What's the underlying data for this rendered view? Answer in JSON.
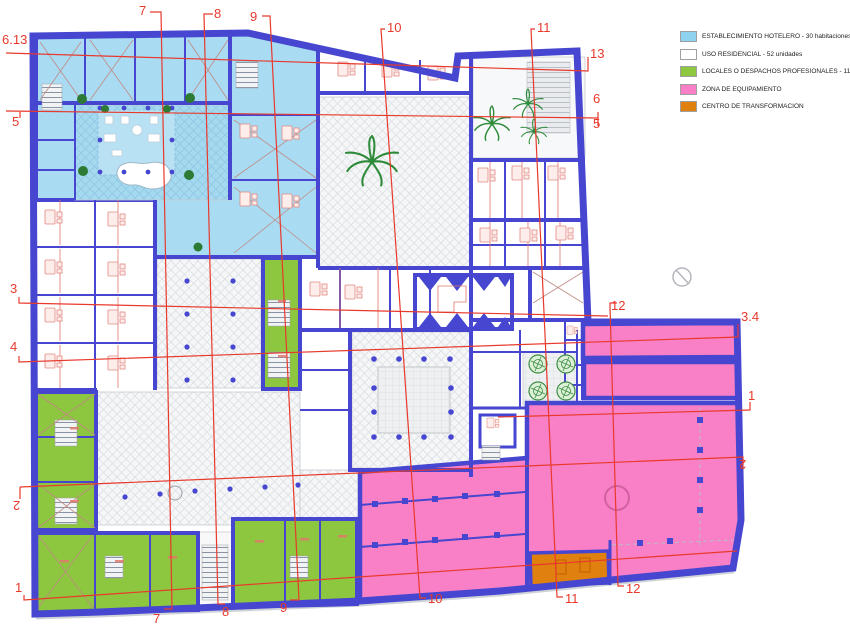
{
  "legend": {
    "items": [
      {
        "id": "hotel",
        "label": "ESTABLECIMIENTO HOTELERO - 30 habitaciones",
        "color": "#8fd2f0"
      },
      {
        "id": "residencial",
        "label": "USO RESIDENCIAL - 52 unidades",
        "color": "#ffffff"
      },
      {
        "id": "locales",
        "label": "LOCALES O DESPACHOS PROFESIONALES - 11 unidades",
        "color": "#8dc63f"
      },
      {
        "id": "equipamiento",
        "label": "ZONA DE EQUIPAMIENTO",
        "color": "#f980c6"
      },
      {
        "id": "transformacion",
        "label": "CENTRO DE TRANSFORMACION",
        "color": "#e0800f"
      }
    ]
  },
  "grid_labels": {
    "top": [
      "7",
      "8",
      "9",
      "10",
      "11"
    ],
    "bottom": [
      "7",
      "8",
      "9",
      "10",
      "11",
      "12"
    ],
    "left": [
      "6.13",
      "5",
      "3",
      "4",
      "2",
      "1"
    ],
    "right": [
      "13",
      "6",
      "5",
      "12",
      "3.4",
      "1",
      "2",
      "12"
    ]
  },
  "colors": {
    "wall_blue": "#4646d0",
    "hotel_blue": "#a9dcf3",
    "legend_hotel_blue": "#8fd2f0",
    "locales_green": "#8dc63f",
    "equipamiento_pink": "#f980c6",
    "transformacion_orange": "#e0800f",
    "grid_red": "#e8392c",
    "furniture_red": "#e2776b"
  }
}
